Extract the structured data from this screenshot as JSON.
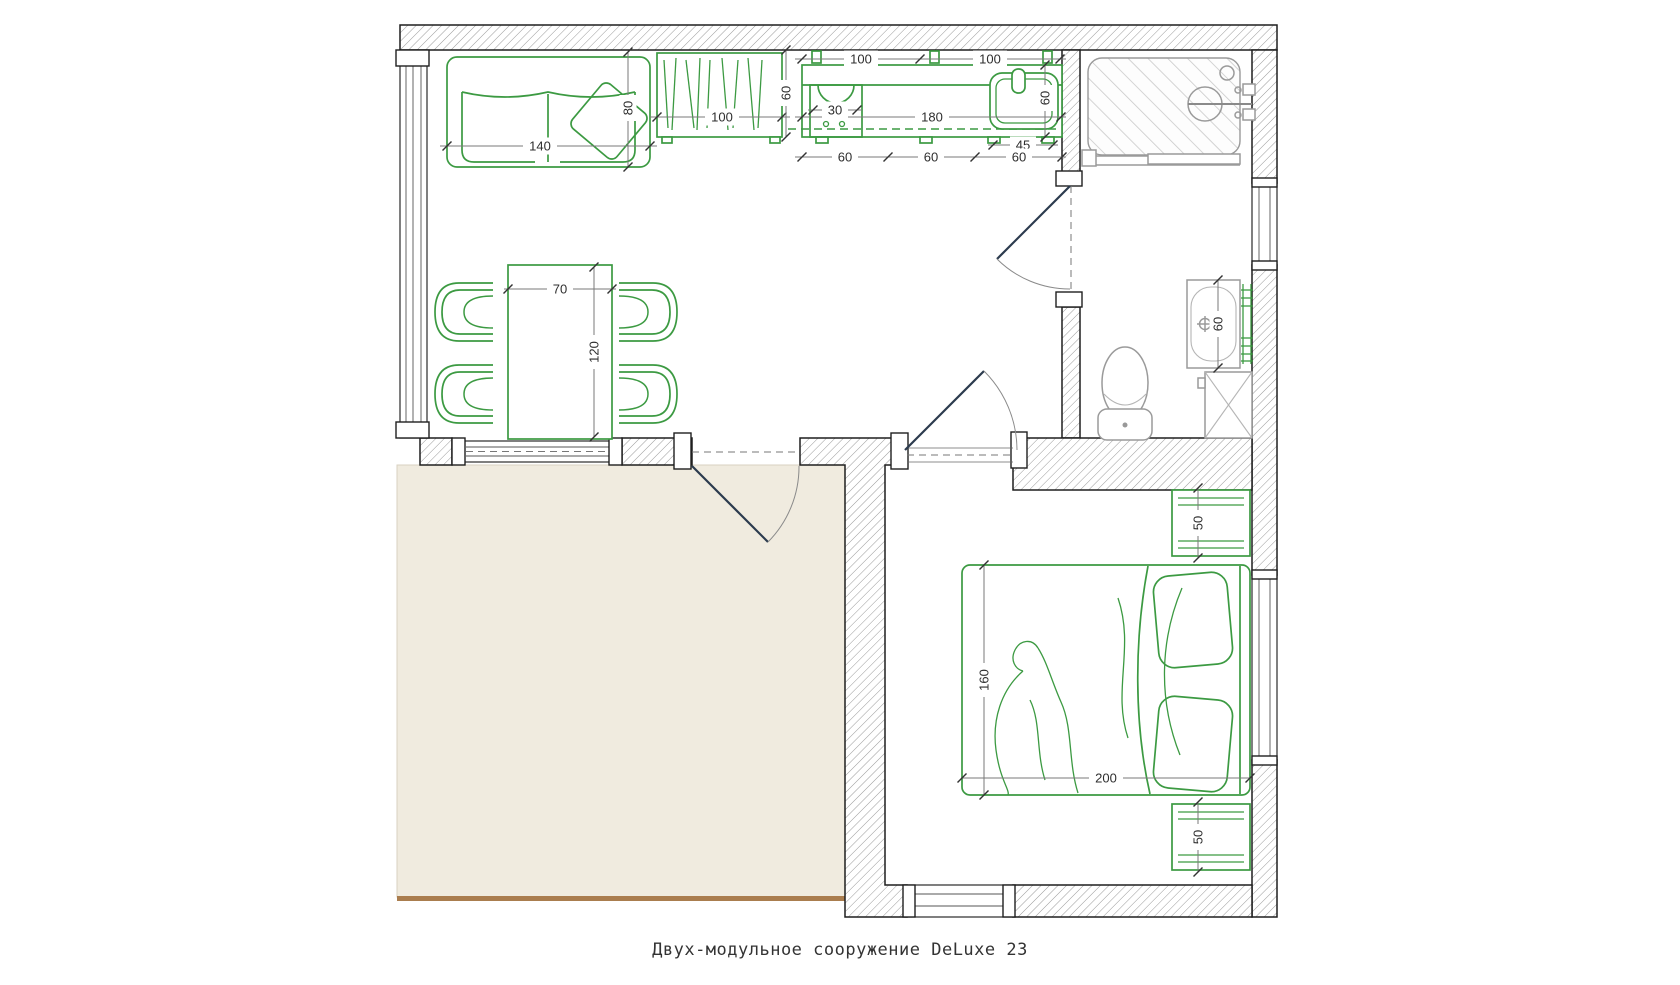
{
  "title": "Двух-модульное сооружение DeLuxe 23",
  "colors": {
    "furniture_green": "#3c9a42",
    "wall_dark": "#1f1f1f",
    "fixture_gray": "#9a9a9a",
    "terrace_fill": "#f0ebdf",
    "terrace_edge": "#aa7d4e",
    "dimension_text": "#2e2e2e"
  },
  "dimensions": {
    "sofa_width": "140",
    "sofa_depth": "80",
    "shelf_width": "100",
    "shelf_depth": "60",
    "upper_cabinet_left": "100",
    "upper_cabinet_right": "100",
    "stove_width": "30",
    "counter_length": "180",
    "sink_depth": "60",
    "sink_width": "45",
    "counter_segment_1": "60",
    "counter_segment_2": "60",
    "counter_segment_3": "60",
    "table_width": "70",
    "table_length": "120",
    "basin_width": "60",
    "bed_width": "160",
    "bed_length": "200",
    "nightstand_top_depth": "50",
    "nightstand_bottom_depth": "50"
  }
}
